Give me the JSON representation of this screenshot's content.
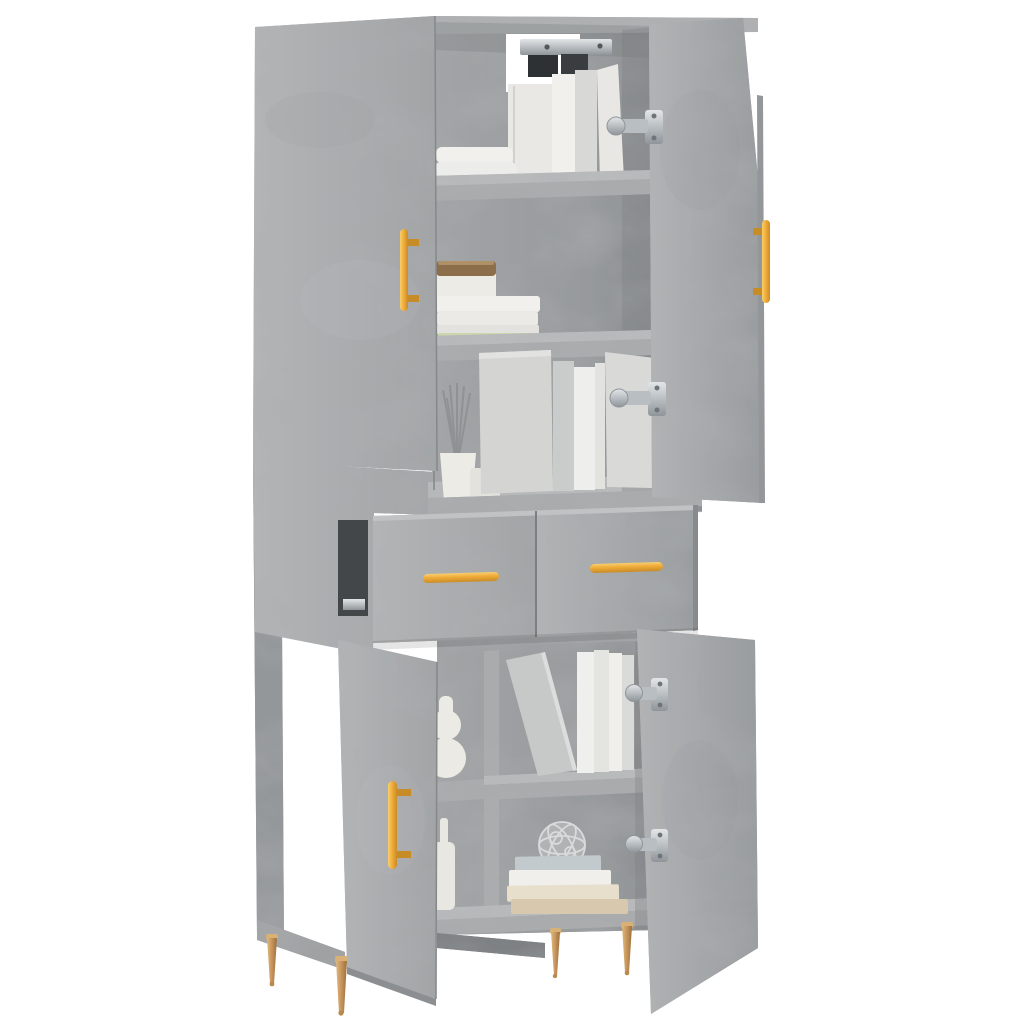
{
  "image": {
    "kind": "product-photo",
    "subject": "tall highboard storage cabinet",
    "finish_name": "concrete grey",
    "background_color": "#ffffff",
    "visible_text": ""
  },
  "palette": {
    "bg": "#ffffff",
    "concrete": "#a9abad",
    "concrete-light": "#b8babc",
    "concrete-mid": "#9fa1a3",
    "concrete-dark": "#94979a",
    "concrete-deep": "#7e8184",
    "recess": "#43474a",
    "gold": "#efaa38",
    "gold-light": "#f8cf6d",
    "gold-deep": "#c88c26",
    "brass": "#c69459",
    "silver": "#c3c8cc",
    "silver-deep": "#8f959a",
    "book-white": "#f1f0ed",
    "book-pale": "#e3e2de",
    "book-grey": "#cfd1d0",
    "book-green": "#ccd5ab",
    "book-blue": "#c2cacd",
    "book-cream": "#e7dfcc",
    "book-tan": "#d8c9ae",
    "ceramic": "#edebe5",
    "wood": "#8d6e4b"
  },
  "cabinet": {
    "upper_section": {
      "left_door": "closed",
      "right_door": "open",
      "door_handle_type": "vertical bar",
      "shelf_count": 2,
      "wall_mount_bracket": true,
      "contents": [
        "lying book stack",
        "standing books",
        "jar with wooden lid",
        "book stack with green book",
        "reed diffuser",
        "file boxes and books"
      ]
    },
    "middle_section": {
      "drawer_state": "open",
      "drawer_fronts": 2,
      "drawer_handle_type": "horizontal bar",
      "drawer_slide_visible": true
    },
    "lower_section": {
      "left_door": "open",
      "right_door": "open",
      "center_divider": true,
      "shelf_count": 2,
      "contents": [
        "gourd vase",
        "bottle vase",
        "leaning book",
        "standing books",
        "decorative wire sphere",
        "stack of books"
      ]
    },
    "hardware": {
      "handle_color": "#efaa38",
      "visible_hinges": 4,
      "legs": {
        "count": 4,
        "style": "tapered spike",
        "color": "#c69459"
      }
    }
  }
}
